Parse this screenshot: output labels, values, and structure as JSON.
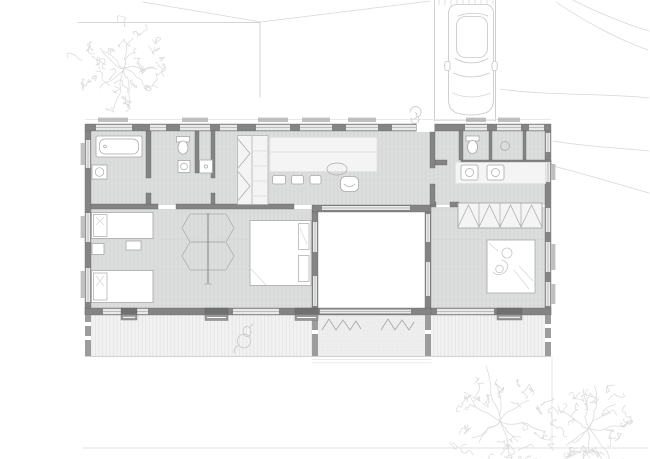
{
  "document": {
    "kind": "Architectural ground-floor plan drawing",
    "visible_text": ""
  },
  "colors": {
    "background": "#ffffff",
    "wall": "#848484",
    "wall_dark": "#5e5e5e",
    "glass": "#e9e9e9",
    "glass_line": "#adadad",
    "floor": "#dcdddd",
    "floor_line": "#d2d3d3",
    "deck": "#f2f2f2",
    "deck_line": "#dedede",
    "garden": "#efefef",
    "garden_line": "#e2e2e2",
    "furniture_fill": "#ffffff",
    "furniture_stroke": "#a8a8a8",
    "sketch": "#c7c7c7",
    "sketch_soft": "#d7d7d7",
    "threshold": "#979797"
  },
  "scene": {
    "site": {
      "parking_bay": {
        "lines": 2,
        "occupied_by": "car"
      },
      "car": {
        "orientation": "nose toward house"
      },
      "trees": [
        {
          "name": "tree-northwest",
          "cx": 124,
          "cy": 68,
          "r": 46,
          "seed": 7
        },
        {
          "name": "tree-southeast-a",
          "cx": 500,
          "cy": 421,
          "r": 58,
          "seed": 13
        },
        {
          "name": "tree-southeast-b",
          "cx": 589,
          "cy": 428,
          "r": 50,
          "seed": 29
        }
      ],
      "boundary_lines": [
        "L-shaped boundary northwest",
        "slope contour curves east",
        "lot line south"
      ]
    },
    "building": {
      "wings": [
        "north service and kitchen bar",
        "west children's bedroom wing",
        "east master bedroom wing"
      ],
      "courtyard": {
        "position": "center",
        "open_to_sky": true
      },
      "deck": {
        "position": "south",
        "boards": "vertical"
      },
      "garden_strip": {
        "position": "south of courtyard",
        "planting": "shrub zigzag rows"
      },
      "rooms": [
        {
          "name": "bathroom",
          "fixtures": [
            "bathtub",
            "washbasin"
          ]
        },
        {
          "name": "shower-room",
          "fixtures": [
            "toilet",
            "washbasin",
            "shower-tray"
          ]
        },
        {
          "name": "walk-in-closet",
          "fixtures": [
            "folding-doors",
            "shelving"
          ]
        },
        {
          "name": "kitchen-dining",
          "fixtures": [
            "counter",
            "bar-stools",
            "round-table",
            "chair"
          ]
        },
        {
          "name": "entry-hall",
          "fixtures": [
            "planter-sketch-outside"
          ]
        },
        {
          "name": "wc",
          "fixtures": [
            "toilet"
          ]
        },
        {
          "name": "utility-room",
          "fixtures": [
            "washbasin"
          ]
        },
        {
          "name": "laundry",
          "fixtures": [
            "washer",
            "dryer"
          ]
        },
        {
          "name": "kids-bedroom",
          "fixtures": [
            "single-bed",
            "single-bed",
            "nightstand",
            "bench",
            "hexagon-partition-wardrobe",
            "double-bed"
          ]
        },
        {
          "name": "master-bedroom",
          "fixtures": [
            "bifold-wardrobe",
            "double-bed",
            "sleeping-figure-sketch"
          ]
        }
      ],
      "deck_sketches": [
        "dog"
      ]
    }
  }
}
